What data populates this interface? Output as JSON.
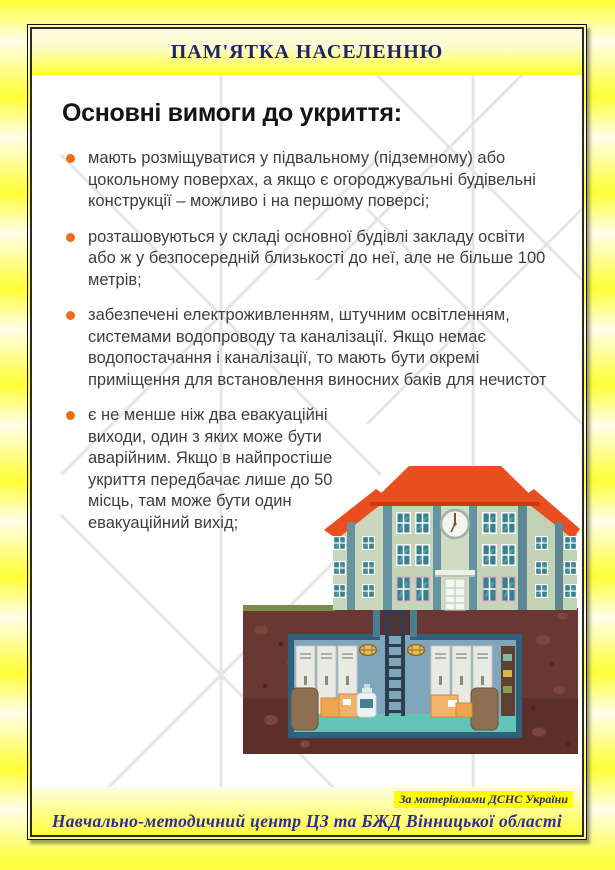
{
  "header": {
    "title": "ПАМ'ЯТКА НАСЕЛЕННЮ"
  },
  "content": {
    "title": "Основні вимоги до укриття:",
    "bullets": [
      "мають розміщуватися у підвальному (підземному) або цокольному поверхах, а якщо є огороджувальні будівельні конструкції – можливо і на першому поверсі;",
      "розташовуються у складі основної будівлі закладу освіти або ж у безпосередній близькості до неї, але не більше 100 метрів;",
      "забезпечені електроживленням, штучним освітленням, системами водопроводу та каналізації. Якщо немає водопостачання і каналізації, то мають бути окремі приміщення для встановлення виносних баків для нечистот",
      "є не менше ніж два евакуаційні виходи, один з яких може бути аварійним. Якщо в найпростіше укриття передбачає лише до 50 місць, там може бути один евакуаційний вихід;"
    ]
  },
  "footer": {
    "source": "За матеріалами ДСНС України",
    "organization": "Навчально-методичний центр ЦЗ та БЖД Вінницької області"
  },
  "illustration": {
    "name": "school-building-with-underground-shelter"
  },
  "colors": {
    "bullet_accent": "#ed6d15",
    "header_text": "#1c2570",
    "footer_text": "#2d2d96",
    "highlight": "#ffff00",
    "roof": "#e94e1e",
    "building_wall": "#c6d4b7",
    "soil": "#6a3832",
    "shelter_wall": "#7fa6ba",
    "shelter_floor": "#63c4b8"
  }
}
